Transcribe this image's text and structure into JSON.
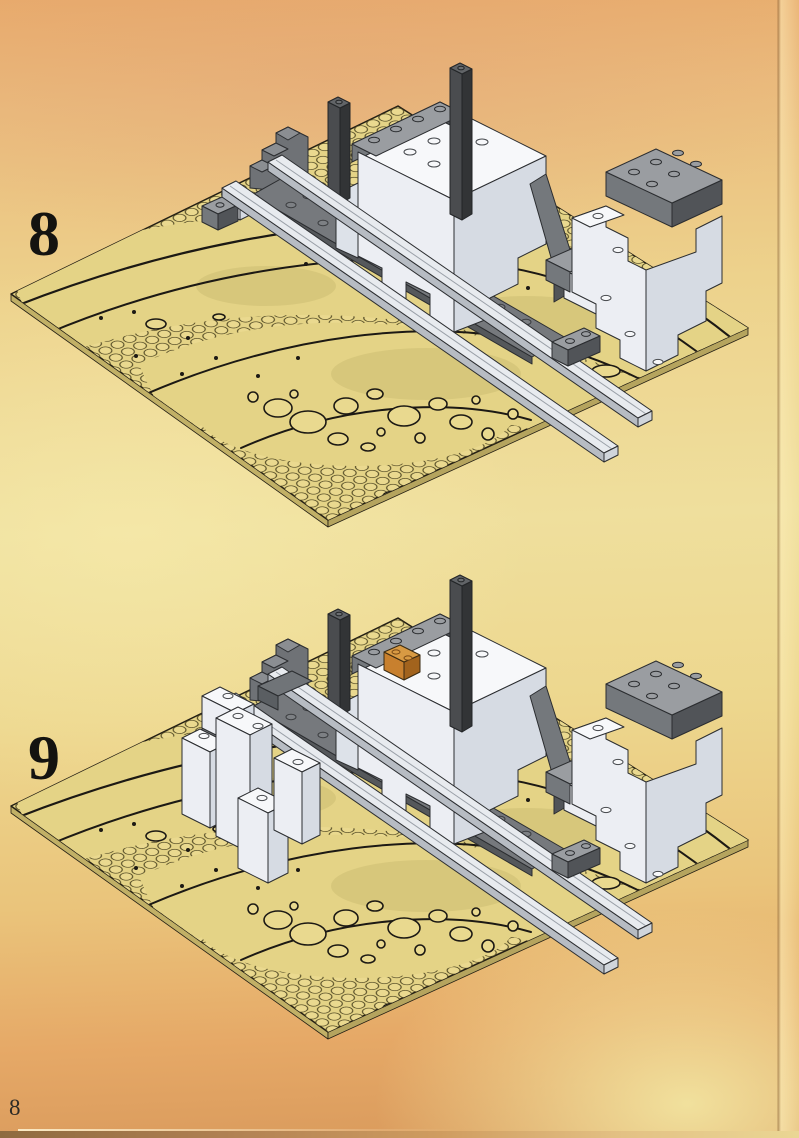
{
  "page": {
    "number": "8"
  },
  "steps": [
    {
      "label": "8"
    },
    {
      "label": "9"
    }
  ],
  "colors": {
    "background_top": "#e8ab6c",
    "background_middle": "#efdf9d",
    "background_bottom_left": "#d99a5c",
    "background_bottom_right": "#f2e4a0",
    "baseplate_tan": "#e4d386",
    "stud_tan": "#ead98f",
    "print_ink": "#1c1914",
    "brick_white": "#eceef3",
    "brick_white_shade": "#d6dbe3",
    "brick_white_top": "#f7f8fa",
    "brick_gray": "#74787c",
    "brick_gray_shade": "#515458",
    "brick_gray_top": "#9a9da1",
    "brick_dark": "#4a4c4f",
    "brick_orange": "#c8802e",
    "rail_light": "#e8ebef"
  }
}
